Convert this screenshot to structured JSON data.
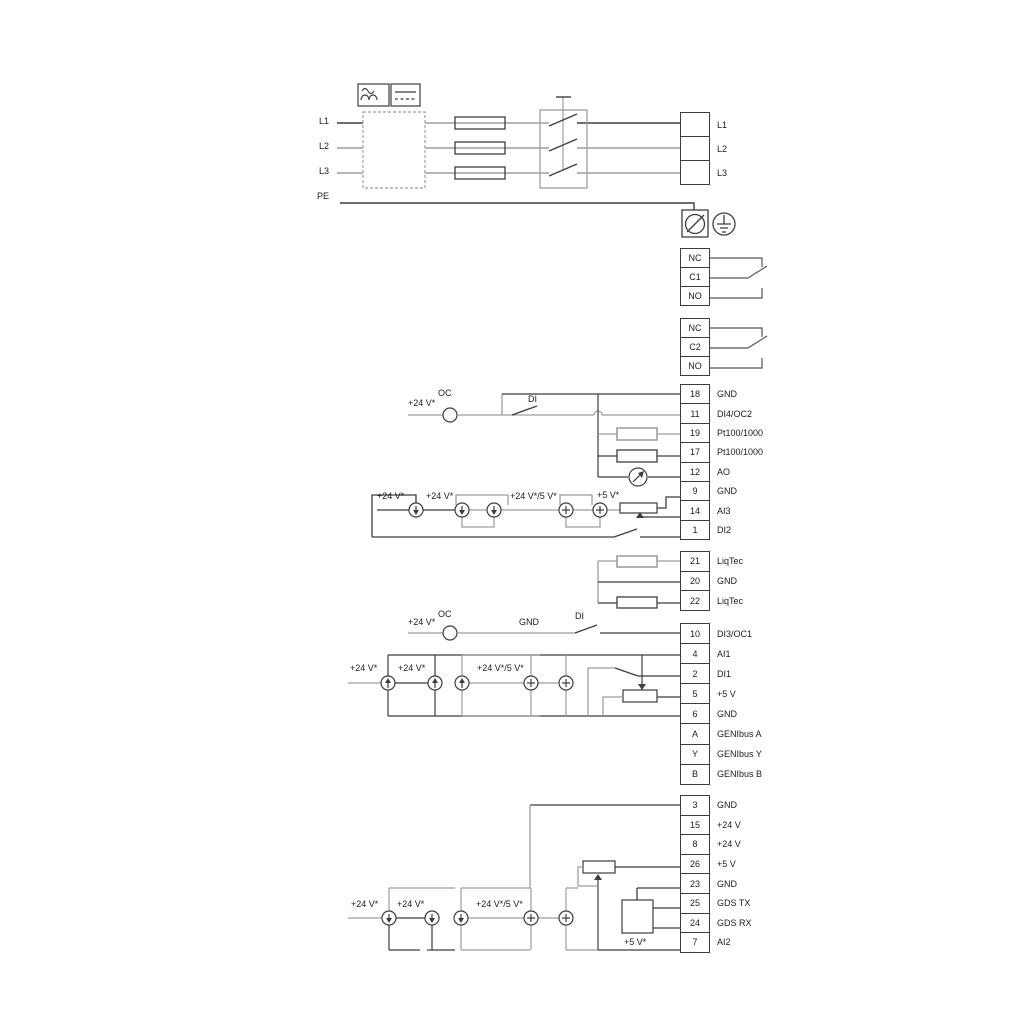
{
  "power": {
    "inputs": {
      "l1": "L1",
      "l2": "L2",
      "l3": "L3",
      "pe": "PE"
    }
  },
  "labels": {
    "v24": "+24 V*",
    "v245": "+24 V*/5 V*",
    "v5": "+5 V*",
    "oc": "OC",
    "di": "DI",
    "gnd": "GND"
  },
  "strips": {
    "power_out": {
      "rows": [
        {
          "num": "",
          "label": "L1"
        },
        {
          "num": "",
          "label": "L2"
        },
        {
          "num": "",
          "label": "L3"
        }
      ]
    },
    "relay1": {
      "rows": [
        {
          "num": "NC",
          "label": ""
        },
        {
          "num": "C1",
          "label": ""
        },
        {
          "num": "NO",
          "label": ""
        }
      ]
    },
    "relay2": {
      "rows": [
        {
          "num": "NC",
          "label": ""
        },
        {
          "num": "C2",
          "label": ""
        },
        {
          "num": "NO",
          "label": ""
        }
      ]
    },
    "io_top": {
      "rows": [
        {
          "num": "18",
          "label": "GND"
        },
        {
          "num": "11",
          "label": "DI4/OC2"
        },
        {
          "num": "19",
          "label": "Pt100/1000"
        },
        {
          "num": "17",
          "label": "Pt100/1000"
        },
        {
          "num": "12",
          "label": "AO"
        },
        {
          "num": "9",
          "label": "GND"
        },
        {
          "num": "14",
          "label": "AI3"
        },
        {
          "num": "1",
          "label": "DI2"
        }
      ]
    },
    "liqtec": {
      "rows": [
        {
          "num": "21",
          "label": "LiqTec"
        },
        {
          "num": "20",
          "label": "GND"
        },
        {
          "num": "22",
          "label": "LiqTec"
        }
      ]
    },
    "io_mid": {
      "rows": [
        {
          "num": "10",
          "label": "DI3/OC1"
        },
        {
          "num": "4",
          "label": "AI1"
        },
        {
          "num": "2",
          "label": "DI1"
        },
        {
          "num": "5",
          "label": "+5 V"
        },
        {
          "num": "6",
          "label": "GND"
        },
        {
          "num": "A",
          "label": "GENIbus A"
        },
        {
          "num": "Y",
          "label": "GENIbus Y"
        },
        {
          "num": "B",
          "label": "GENIbus B"
        }
      ]
    },
    "io_bottom": {
      "rows": [
        {
          "num": "3",
          "label": "GND"
        },
        {
          "num": "15",
          "label": "+24 V"
        },
        {
          "num": "8",
          "label": "+24 V"
        },
        {
          "num": "26",
          "label": "+5 V"
        },
        {
          "num": "23",
          "label": "GND"
        },
        {
          "num": "25",
          "label": "GDS TX"
        },
        {
          "num": "24",
          "label": "GDS RX"
        },
        {
          "num": "7",
          "label": "AI2"
        }
      ]
    }
  },
  "colors": {
    "wire_dark": "#3d3d3d",
    "wire_gray": "#9e9e9e"
  }
}
